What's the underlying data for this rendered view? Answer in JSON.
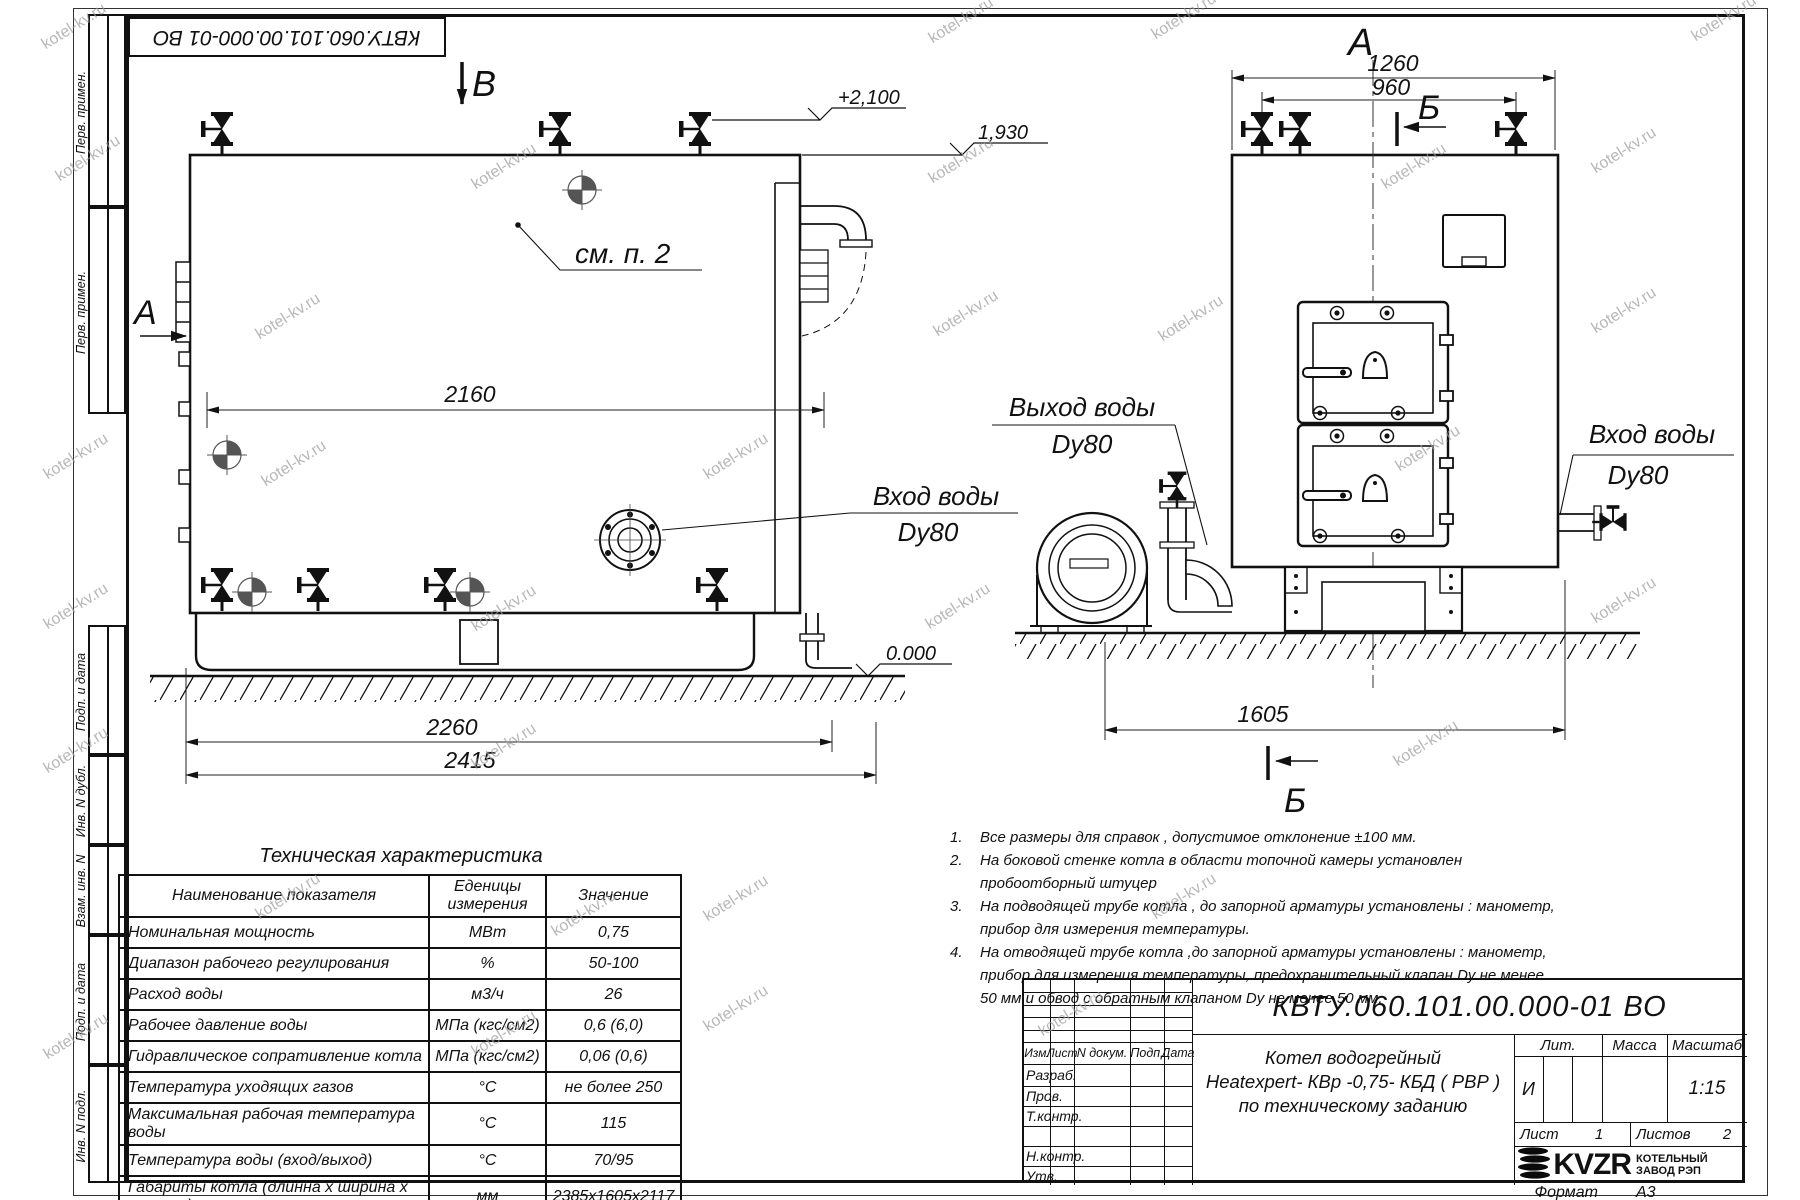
{
  "watermark": {
    "text": "kotel-kv.ru"
  },
  "stamps": {
    "top_code": "КВТУ.060.101.00.000-01 ВО",
    "margin_labels": [
      "Перв. примен.",
      "Перв. примен.",
      "Подп. и дата",
      "Инв. N дубл.",
      "Взам. инв. N",
      "Подп. и дата",
      "Инв. N подл."
    ]
  },
  "views": {
    "section_v": "В",
    "view_a_side": "А",
    "view_a_front": "А",
    "section_b": "Б",
    "callout_see_p2": "см. п. 2",
    "elev_top": "+2,100",
    "elev_mid": "1,930",
    "elev_zero": "0.000",
    "dims": {
      "inner_len": "2160",
      "len": "2260",
      "total_len": "2415",
      "front_w": "1260",
      "front_w2": "960",
      "width": "1605"
    },
    "labels": {
      "inlet_side": {
        "line1": "Вход воды",
        "line2": "Dy80"
      },
      "outlet_front": {
        "line1": "Выход воды",
        "line2": "Dy80"
      },
      "inlet_front": {
        "line1": "Вход воды",
        "line2": "Dy80"
      }
    }
  },
  "notes": {
    "items": [
      {
        "num": "1.",
        "text": "Все размеры для справок , допустимое отклонение  ±100 мм."
      },
      {
        "num": "2.",
        "text": "На боковой стенке котла в области топочной камеры установлен пробоотборный штуцер"
      },
      {
        "num": "3.",
        "text": "На  подводящей трубе котла , до запорной арматуры установлены : манометр, прибор для измерения температуры."
      },
      {
        "num": "4.",
        "text": "На отводящей трубе котла ,до запорной арматуры установлены : манометр, прибор для измерения температуры, предохранительный клапан  Dу не менее  50 мм и обвод с обратным клапаном  Dу не менее  50 мм."
      }
    ]
  },
  "spec_table": {
    "title": "Техническая характеристика",
    "headers": [
      "Наименование показателя",
      "Еденицы измерения",
      "Значение"
    ],
    "rows": [
      [
        "Номинальная мощность",
        "МВт",
        "0,75"
      ],
      [
        "Диапазон рабочего регулирования",
        "%",
        "50-100"
      ],
      [
        "Расход воды",
        "м3/ч",
        "26"
      ],
      [
        "Рабочее давление воды",
        "МПа (кгс/см2)",
        "0,6 (6,0)"
      ],
      [
        "Гидравлическое сопративление котла",
        "МПа (кгс/см2)",
        "0,06 (0,6)"
      ],
      [
        "Температура уходящих газов",
        "°С",
        "не более 250"
      ],
      [
        "Максимальная рабочая температура воды",
        "°С",
        "115"
      ],
      [
        "Температура воды (вход/выход)",
        "°С",
        "70/95"
      ],
      [
        "Габариты котла (длинна х ширина х высота)",
        "мм",
        "2385х1605х2117"
      ]
    ]
  },
  "title_block": {
    "designation": "КВТУ.060.101.00.000-01 ВО",
    "name_line1": "Котел водогрейный",
    "name_line2": "Heatexpert- КВр -0,75- КБД ( РВР )",
    "name_line3": "по техническому заданию",
    "col_izm": "Изм.",
    "col_list": "Лист",
    "col_ndoc": "N докум.",
    "col_podp": "Подп.",
    "col_data": "Дата",
    "role_razrab": "Разраб.",
    "role_prov": "Пров.",
    "role_tkontr": "Т.контр.",
    "role_nkontr": "Н.контр.",
    "role_utv": "Утв.",
    "lit_label": "Лит.",
    "massa_label": "Масса",
    "masshtab_label": "Масштаб",
    "lit_value": "И",
    "scale_value": "1:15",
    "sheet_label": "Лист",
    "sheet_value": "1",
    "sheets_label": "Листов",
    "sheets_value": "2",
    "logo_text": "KVZR",
    "org_line1": "КОТЕЛЬНЫЙ",
    "org_line2": "ЗАВОД РЭП",
    "format_label": "Формат",
    "format_value": "А3"
  }
}
